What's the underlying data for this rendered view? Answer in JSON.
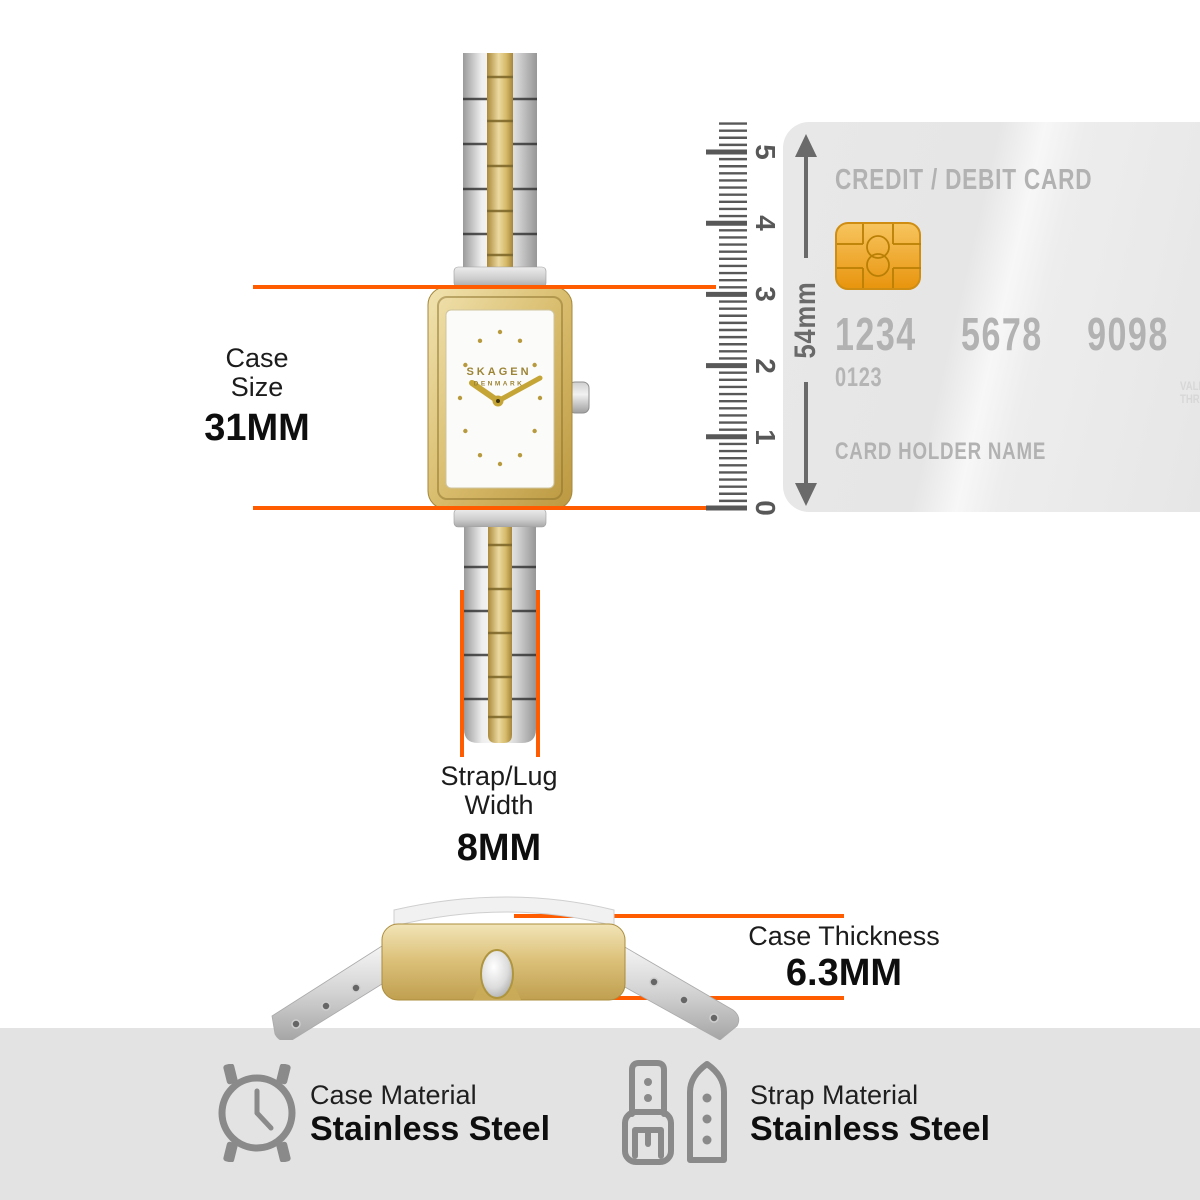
{
  "watch": {
    "brand": "SKAGEN",
    "brand_sub": "DENMARK"
  },
  "measurements": {
    "case_size": {
      "line1": "Case",
      "line2": "Size",
      "value": "31MM"
    },
    "strap_width": {
      "line1": "Strap/Lug",
      "line2": "Width",
      "value": "8MM"
    },
    "case_thickness": {
      "label": "Case Thickness",
      "value": "6.3MM"
    }
  },
  "ruler": {
    "length_label": "54mm",
    "tick_labels": [
      "0",
      "1",
      "2",
      "3",
      "4",
      "5"
    ]
  },
  "card": {
    "title": "CREDIT / DEBIT CARD",
    "number_groups": [
      "1234",
      "5678",
      "9098"
    ],
    "sub_number": "0123",
    "holder_label": "CARD HOLDER NAME",
    "valid_thru_line1": "VALID",
    "valid_thru_line2": "THRU"
  },
  "materials": {
    "case": {
      "label": "Case Material",
      "value": "Stainless Steel"
    },
    "strap": {
      "label": "Strap Material",
      "value": "Stainless Steel"
    }
  },
  "colors": {
    "accent": "#FF5C00",
    "gold": "#D2B260",
    "card_text": "#B2B2B2",
    "footer_bg": "#E3E3E3",
    "ruler_gray": "#585858"
  }
}
